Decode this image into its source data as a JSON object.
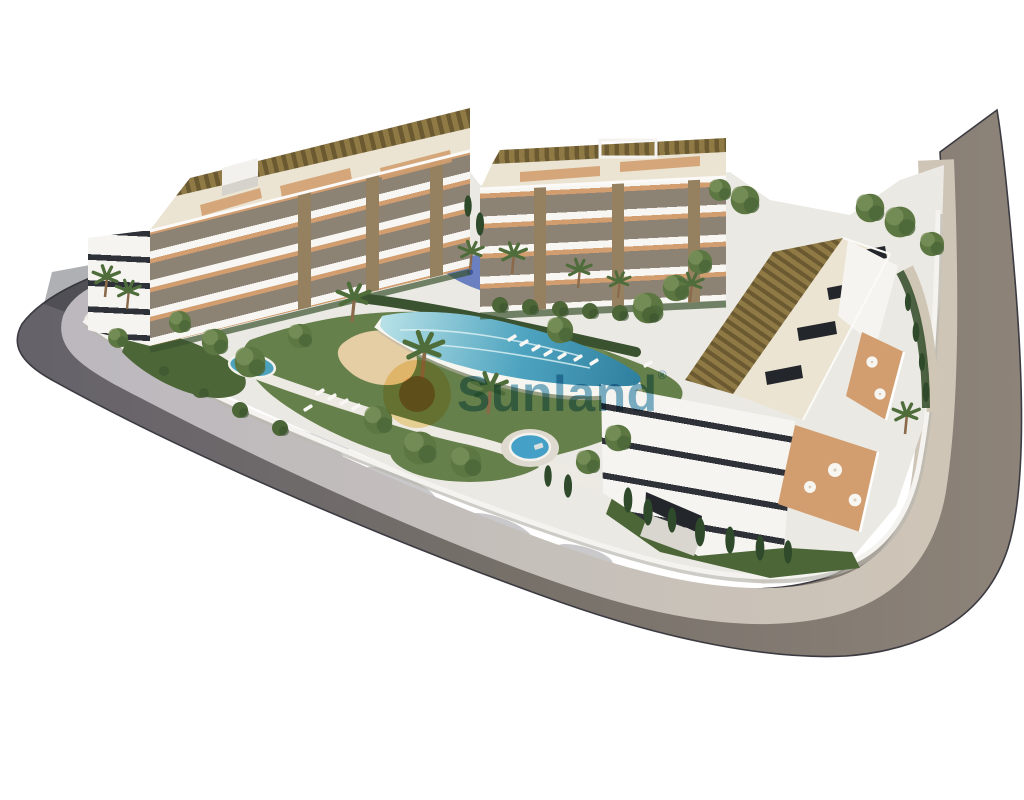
{
  "watermark": {
    "text": "Sunland",
    "registered": "®",
    "icon": "sun-icon"
  },
  "palette": {
    "background": "#ffffff",
    "road-cool": "#64616a",
    "road-mid": "#767069",
    "road-warm": "#8d8379",
    "curb-shadow": "#3c3b42",
    "sidewalk-cool": "#bab7bf",
    "sidewalk-warm": "#d0c6b6",
    "site-ground": "#ebe9e3",
    "wall-white": "#f4f3ef",
    "wall-shade": "#b9b6ae",
    "facade-white": "#f5f4f0",
    "facade-recess": "#8d8374",
    "slab-white": "#f7f6f2",
    "window-dark": "#2e3238",
    "terrace-terracotta": "#d29e70",
    "pergola-brown": "#8f7a45",
    "pergola-slat": "#6b5a31",
    "roof-cream": "#ece4d2",
    "skylight-dark": "#23262b",
    "stone-pillar": "#95815f",
    "lawn-green": "#66804c",
    "lawn-light": "#7b9159",
    "hedge-dark": "#3a522f",
    "shrub-green": "#4c6638",
    "tree-green": "#5d7743",
    "cypress-green": "#2f4a2a",
    "palm-green": "#4f6d3a",
    "trunk-brown": "#8a6a4a",
    "pool-light": "#b9e2e8",
    "pool-turquoise": "#4da3bf",
    "pool-deep": "#2f7f9f",
    "sand-beach": "#e5cda4",
    "splash-blue": "#5e76bd",
    "jacuzzi-blue": "#45a0c8",
    "lounger-white": "#f8f7f3",
    "shadow-tint": "#2e2f36",
    "watermark-blue": "rgba(47,133,173,0.62)",
    "sun-yellow": "rgba(243,197,74,0.5)",
    "sun-orange": "rgba(227,130,57,0.72)"
  }
}
